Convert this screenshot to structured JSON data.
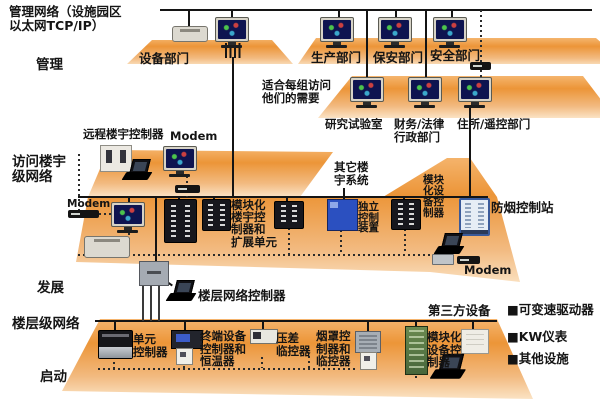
{
  "labels": {
    "title": "管理网络（设施园区\n以太网TCP/IP）",
    "level_management": "管理",
    "level_access": "访问楼宇\n级网络",
    "level_development": "发展",
    "level_floor": "楼层级网络",
    "level_startup": "启动"
  },
  "management_level": {
    "equipment_dept": "设备部门",
    "production_dept": "生产部门",
    "security_dept": "保安部门",
    "safety_dept": "安全部门",
    "note": "适合每组访问\n他们的需要",
    "research_lab": "研究试验室",
    "finance_legal_admin": "财务/法律\n行政部门",
    "residence_remote_dept": "住所/遥控部门"
  },
  "access_level": {
    "remote_building_controller": "远程楼宇控制器",
    "modem_top": "Modem",
    "modem_left": "Modem",
    "modular_building_controller_expansion": "模块化\n楼宇控\n制器和\n扩展单元",
    "other_building_systems": "其它楼\n宇系统",
    "independent_control_device": "独立\n控制\n装置",
    "modular_equipment_controller": "模块\n化设\n备控\n制器",
    "smoke_control_station": "防烟控制站",
    "modem_right": "Modem"
  },
  "development_level": {
    "floor_network_controller": "楼层网络控制器"
  },
  "floor_level": {
    "unit_controller": "单元\n控制器",
    "terminal_device_controller_thermostat": "终端设备\n控制器和\n恒温器",
    "differential_pressure_monitor": "压差\n临控器",
    "hood_controller_monitor": "烟罩控\n制器和\n临控器",
    "modular_equipment_controller": "模块化\n设备控\n制器",
    "third_party_devices": "第三方设备"
  },
  "legend": {
    "variable_speed_drives": "■可变速驱动器",
    "kw_meters": "■KW仪表",
    "other_facilities": "■其他设施"
  },
  "colors": {
    "platform_orange": "#ec9538",
    "platform_light": "#fbe3c4",
    "line_black": "#141414",
    "device_blue": "#2b50c0",
    "device_green": "#57773f",
    "screen_navy": "#0e1450"
  }
}
